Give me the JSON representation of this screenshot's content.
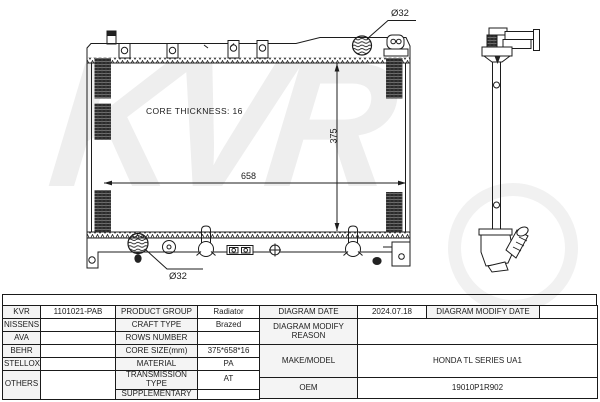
{
  "watermark": {
    "text": "KVR"
  },
  "drawing": {
    "core_thickness_label": "CORE THICKNESS: 16",
    "dim_width": "658",
    "dim_height": "375",
    "inlet_diameter": "Ø32",
    "outlet_diameter": "Ø32"
  },
  "colors": {
    "line": "#1c1c1c",
    "label_cell_bg": "#f4f4f4",
    "watermark": "#eeeeee"
  },
  "table": {
    "brands": {
      "r1": "KVR",
      "r2": "NISSENS",
      "r3": "AVA",
      "r4": "BEHR",
      "r5": "STELLOX",
      "r6": "OTHERS"
    },
    "part_number": "1101021-PAB",
    "left_labels": {
      "product_group": "PRODUCT GROUP",
      "craft_type": "CRAFT TYPE",
      "rows_number": "ROWS NUMBER",
      "core_size": "CORE SIZE(mm)",
      "material": "MATERIAL",
      "transmission_type": "TRANSMISSION TYPE",
      "supplementary": "SUPPLEMENTARY"
    },
    "left_values": {
      "product_group": "Radiator",
      "craft_type": "Brazed",
      "rows_number": "",
      "core_size": "375*658*16",
      "material": "PA",
      "transmission_type": "AT",
      "supplementary": ""
    },
    "right": {
      "diagram_date_label": "DIAGRAM DATE",
      "diagram_date": "2024.07.18",
      "modify_date_label": "DIAGRAM MODIFY DATE",
      "modify_date": "",
      "modify_reason_label": "DIAGRAM MODIFY REASON",
      "modify_reason": "",
      "make_model_label": "MAKE/MODEL",
      "make_model": "HONDA TL SERIES UA1",
      "oem_label": "OEM",
      "oem": "19010P1R902"
    }
  }
}
